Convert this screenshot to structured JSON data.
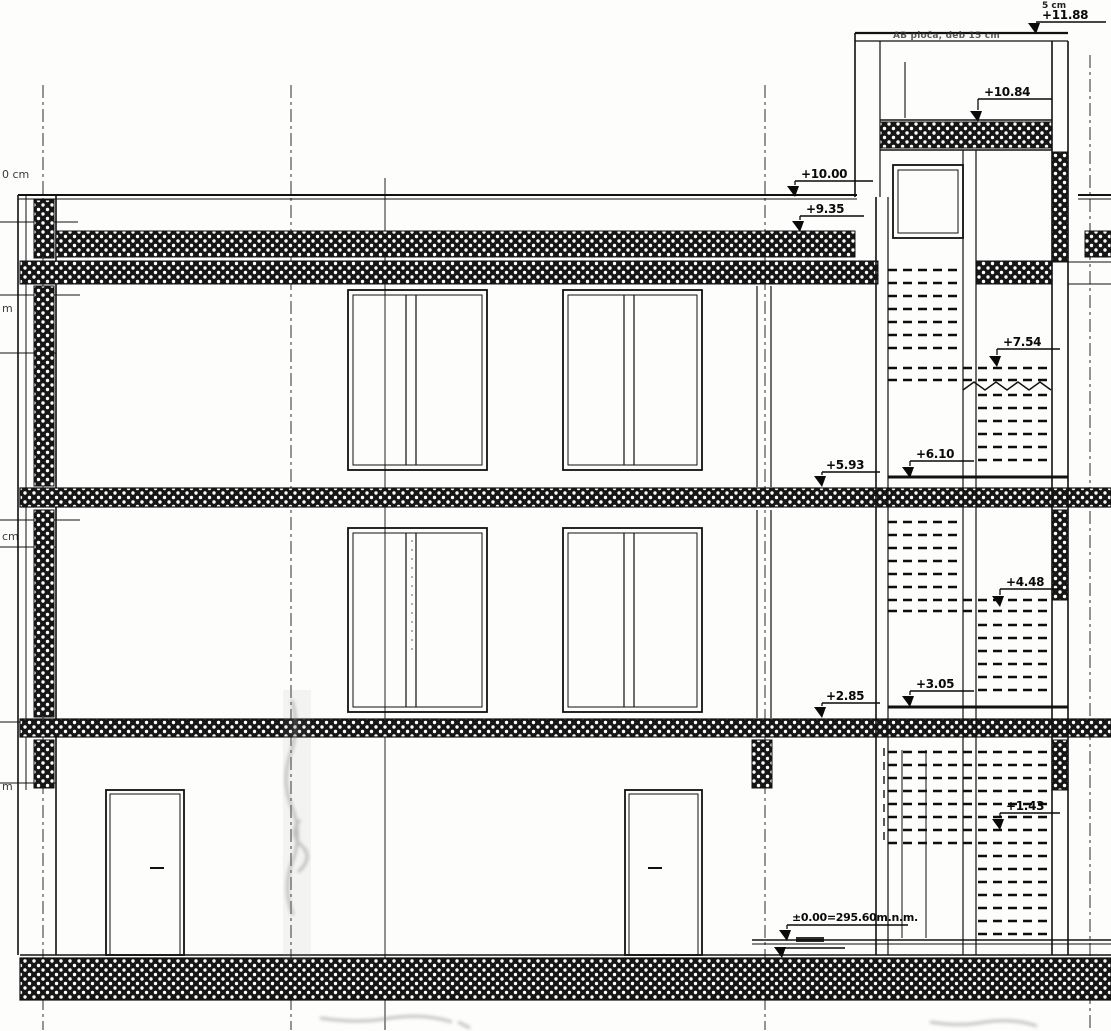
{
  "drawing": {
    "kind": "architectural building cross-section",
    "top_dimension_note": "5 cm",
    "tower_slab_note": "AB ploča, deb 15 cm",
    "elevation_markers": [
      {
        "id": "tower-top",
        "label": "+11.88"
      },
      {
        "id": "tower-roof-slab",
        "label": "+10.84"
      },
      {
        "id": "main-roof-top",
        "label": "+10.00"
      },
      {
        "id": "main-roof-slab",
        "label": "+9.35"
      },
      {
        "id": "stair-landing-4",
        "label": "+7.54"
      },
      {
        "id": "floor-2-finished",
        "label": "+6.10"
      },
      {
        "id": "floor-2-structural",
        "label": "+5.93"
      },
      {
        "id": "stair-landing-2",
        "label": "+4.48"
      },
      {
        "id": "floor-1-finished",
        "label": "+3.05"
      },
      {
        "id": "floor-1-structural",
        "label": "+2.85"
      },
      {
        "id": "stair-landing-1",
        "label": "+1.43"
      },
      {
        "id": "ground-datum",
        "label": "±0.00=295.60m.n.m."
      }
    ],
    "left_margin_labels": [
      {
        "label": "0 cm"
      },
      {
        "label": "m"
      },
      {
        "label": "cm"
      },
      {
        "label": "m"
      }
    ],
    "colors": {
      "ink": "#141414",
      "paper": "#fdfdfc"
    }
  }
}
